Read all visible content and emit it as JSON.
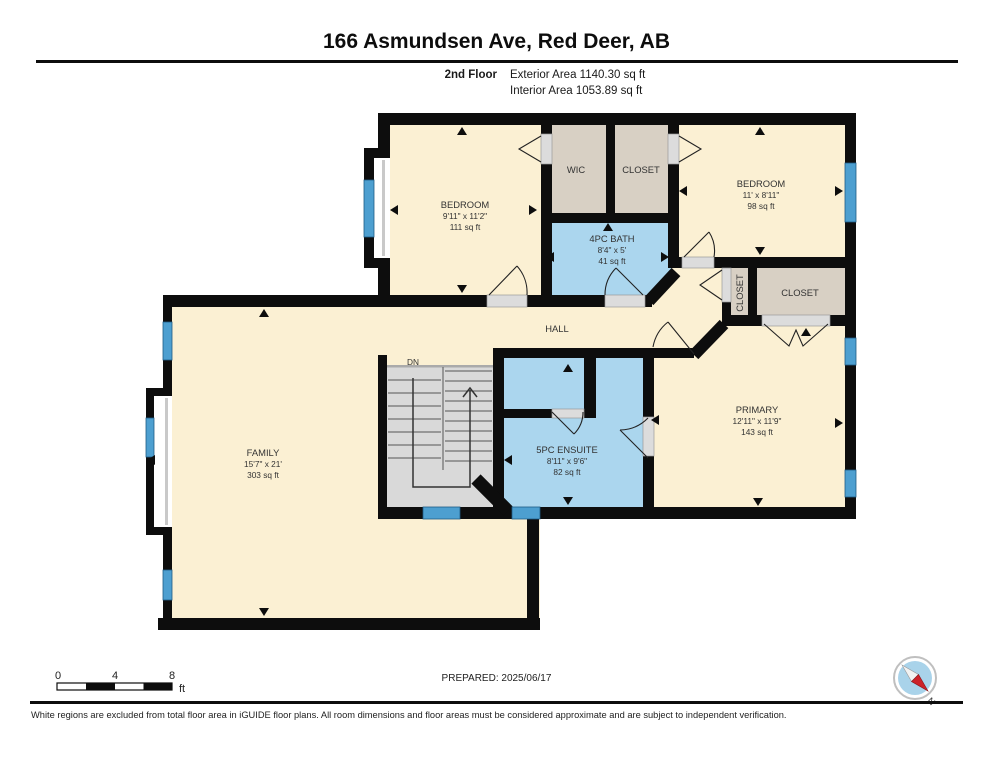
{
  "header": {
    "title": "166 Asmundsen Ave, Red Deer, AB",
    "floor_label": "2nd Floor",
    "exterior_area": "Exterior Area 1140.30 sq ft",
    "interior_area": "Interior Area 1053.89 sq ft"
  },
  "rooms": {
    "bedroom1": {
      "name": "BEDROOM",
      "dims": "9'11\" x 11'2\"",
      "area": "111 sq ft"
    },
    "wic": {
      "name": "WIC"
    },
    "closet_top": {
      "name": "CLOSET"
    },
    "bedroom2": {
      "name": "BEDROOM",
      "dims": "11' x 8'11\"",
      "area": "98 sq ft"
    },
    "bath": {
      "name": "4PC BATH",
      "dims": "8'4\" x 5'",
      "area": "41 sq ft"
    },
    "closet_vertical": {
      "name": "CLOSET"
    },
    "closet_primary": {
      "name": "CLOSET"
    },
    "hall": {
      "name": "HALL"
    },
    "stairs": {
      "label": "DN"
    },
    "family": {
      "name": "FAMILY",
      "dims": "15'7\" x 21'",
      "area": "303 sq ft"
    },
    "ensuite": {
      "name": "5PC ENSUITE",
      "dims": "8'11\" x 9'6\"",
      "area": "82 sq ft"
    },
    "primary": {
      "name": "PRIMARY",
      "dims": "12'11\" x 11'9\"",
      "area": "143 sq ft"
    }
  },
  "scale_bar": {
    "tick0": "0",
    "tick4": "4",
    "tick8": "8",
    "unit": "ft"
  },
  "footer": {
    "prepared": "PREPARED: 2025/06/17",
    "disclaimer": "White regions are excluded from total floor area in iGUIDE floor plans. All room dimensions and floor areas must be considered approximate and are subject to independent verification.",
    "compass_label": "N"
  },
  "colors": {
    "room_fill": "#FBF0D3",
    "closet_fill": "#D8D0C4",
    "bath_fill": "#ABD6EE",
    "window_blue": "#4D9FD0",
    "wall": "#0d0d0d",
    "stairs_gray": "#D9D9D9",
    "compass_blue": "#A9D3EA",
    "compass_red": "#CC2229"
  }
}
